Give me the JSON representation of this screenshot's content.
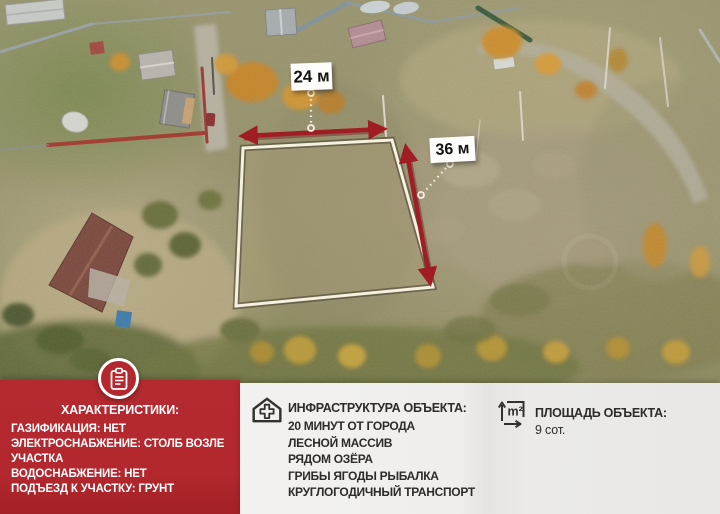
{
  "measurements": {
    "width_label": "24 м",
    "length_label": "36 м"
  },
  "characteristics": {
    "title": "ХАРАКТЕРИСТИКИ:",
    "items": [
      "ГАЗИФИКАЦИЯ: НЕТ",
      "ЭЛЕКТРОСНАБЖЕНИЕ: СТОЛБ ВОЗЛЕ УЧАСТКА",
      "ВОДОСНАБЖЕНИЕ: НЕТ",
      "ПОДЪЕЗД К УЧАСТКУ: ГРУНТ"
    ]
  },
  "infrastructure": {
    "title": "ИНФРАСТРУКТУРА ОБЪЕКТА:",
    "items": [
      "20 МИНУТ ОТ ГОРОДА",
      "ЛЕСНОЙ МАССИВ",
      "РЯДОМ ОЗЁРА",
      "ГРИБЫ ЯГОДЫ РЫБАЛКА",
      "КРУГЛОГОДИЧНЫЙ ТРАНСПОРТ"
    ]
  },
  "area": {
    "title": "ПЛОЩАДЬ ОБЪЕКТА:",
    "value": "9 сот.",
    "icon_label": "m²"
  },
  "colors": {
    "accent_red": "#b2282e",
    "arrow_red": "#a01d23",
    "panel_light": "#efeeec",
    "text_dark": "#2e2c29",
    "plot_outline": "#f6f0de"
  }
}
